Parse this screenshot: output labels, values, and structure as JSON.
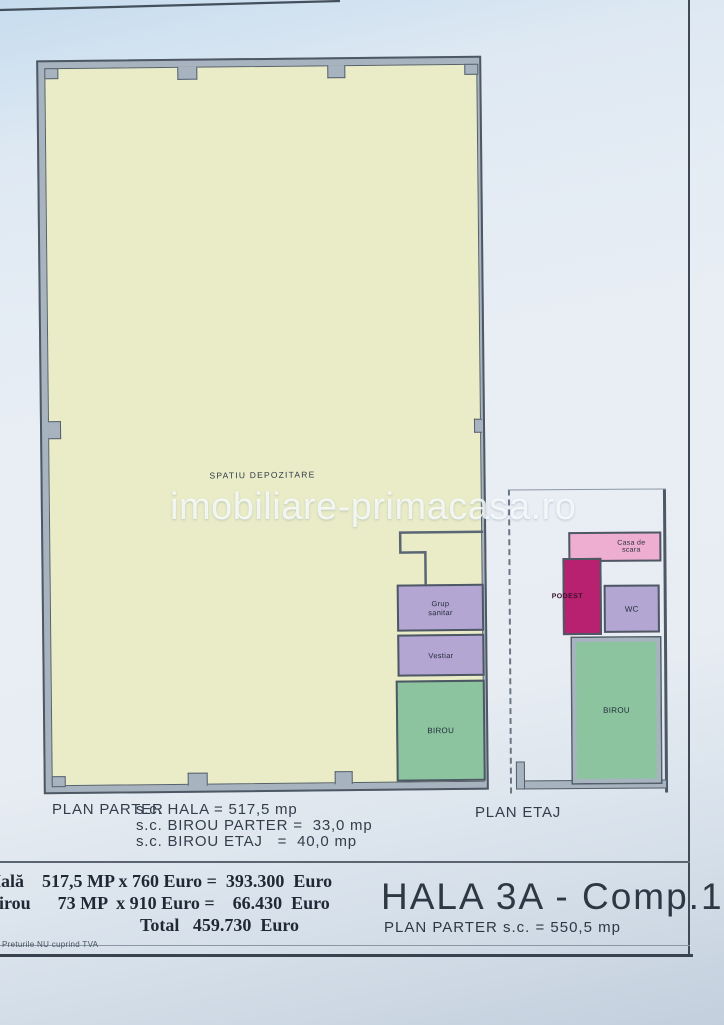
{
  "watermark": "imobiliare-primacasa.ro",
  "plan_parter": {
    "storage_label": "SPATIU DEPOZITARE",
    "rooms": {
      "grup_sanitar": "Grup sanitar",
      "vestiar": "Vestiar",
      "birou": "BIROU"
    }
  },
  "plan_etaj": {
    "rooms": {
      "casa_de_scara": "Casa de scara",
      "podest": "PODEST",
      "wc": "WC",
      "birou": "BIROU"
    }
  },
  "annotations": {
    "plan_parter_label": "PLAN PARTER",
    "sc_hala": "s.c. HALA = 517,5 mp",
    "sc_birou_parter": "s.c. BIROU PARTER =  33,0 mp",
    "sc_birou_etaj": "s.c. BIROU ETAJ   =  40,0 mp",
    "plan_etaj_label": "PLAN ETAJ"
  },
  "pricing": {
    "hala_line": "Hală    517,5 MP x 760 Euro =  393.300  Euro",
    "birou_line": "Birou      73 MP  x 910 Euro =    66.430  Euro",
    "total_line": "Total   459.730  Euro",
    "vat_note": "Preturile NU cuprind TVA"
  },
  "title_block": {
    "title": "HALA 3A - Comp.1",
    "subtitle": "PLAN PARTER  s.c. = 550,5 mp"
  },
  "colors": {
    "hall_fill": "#e9ecc6",
    "wall_band": "#a8b3c0",
    "wall_line": "#4d5864",
    "room_purple": "#b4a6d3",
    "room_green": "#8cc4a0",
    "room_pink": "#eeaed1",
    "room_magenta": "#b8216f",
    "ink": "#2f3a47"
  }
}
